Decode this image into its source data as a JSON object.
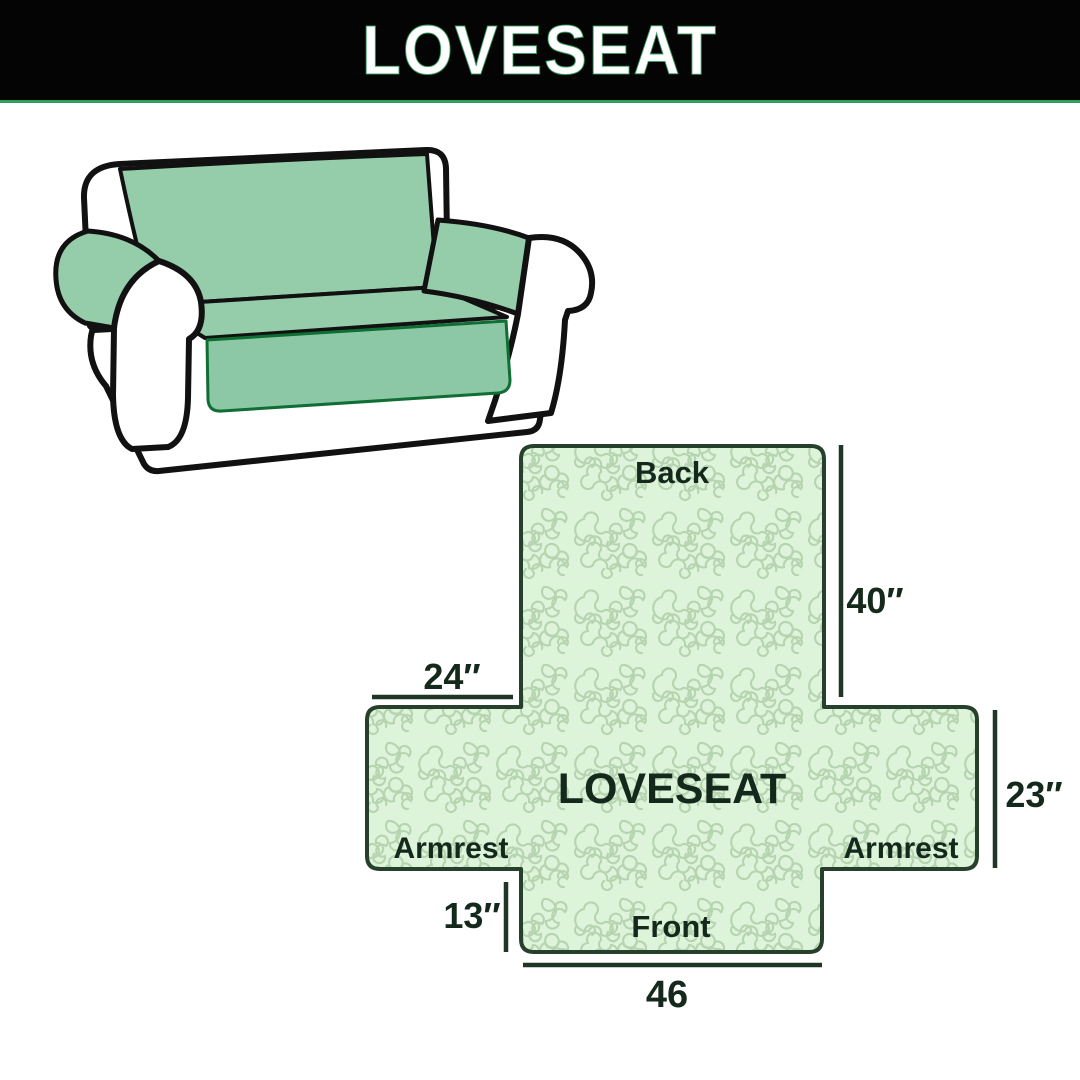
{
  "banner": {
    "title": "LOVESEAT"
  },
  "diagram": {
    "product_label": "LOVESEAT",
    "sections": {
      "back": "Back",
      "front": "Front",
      "armrest_left": "Armrest",
      "armrest_right": "Armrest"
    },
    "dimensions": {
      "back_height": "40″",
      "armrest_width": "24″",
      "side_height": "23″",
      "front_drop": "13″",
      "front_width": "46"
    }
  },
  "colors": {
    "banner_bg": "#040404",
    "banner_text": "#ffffff",
    "accent_green": "#2f9e5d",
    "sofa_cover_green": "#95cdab",
    "sofa_cover_skirt_green": "#8cc8a5",
    "sofa_cover_edge_green": "#0e6e33",
    "sofa_outline_black": "#111111",
    "diagram_fill": "#ddf3da",
    "diagram_pattern_line": "#b6d4b0",
    "diagram_outline": "#26402b",
    "dimension_line": "#1f3526",
    "label_text": "#14291b"
  }
}
